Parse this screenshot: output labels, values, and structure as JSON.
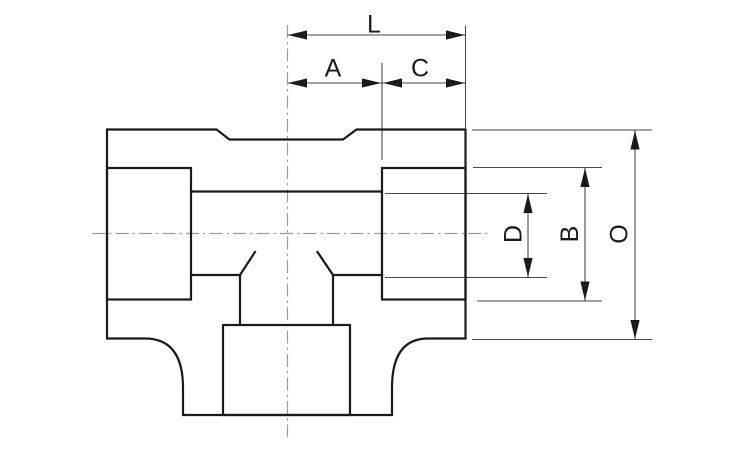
{
  "drawing": {
    "dimension_labels": {
      "L": "L",
      "A": "A",
      "C": "C",
      "D": "D",
      "B": "B",
      "O": "O"
    },
    "colors": {
      "outline": "#1a1a1a",
      "dimension_lines": "#4a4a4a",
      "centerlines": "#9b9b9b",
      "background": "#ffffff"
    }
  }
}
